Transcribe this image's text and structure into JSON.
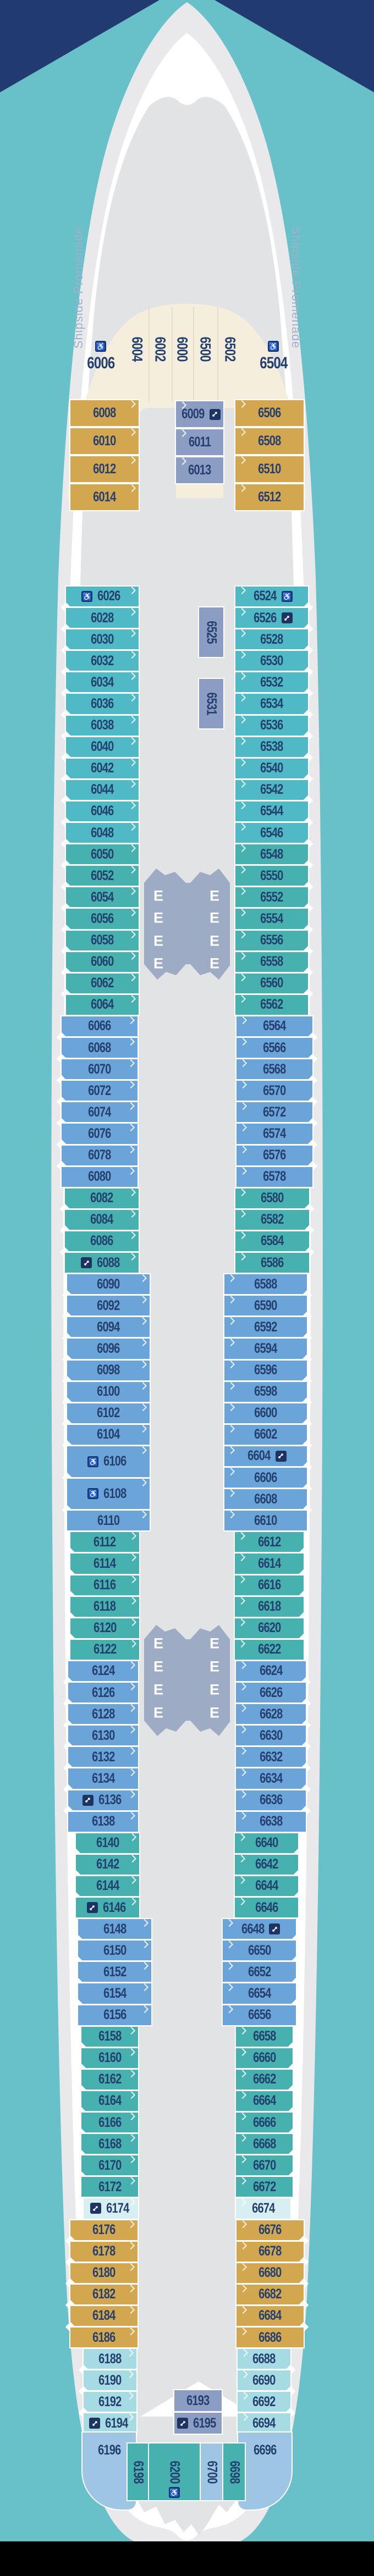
{
  "deck_plan": {
    "promenade_label": "Shipside Promenade",
    "elevator_letter": "E",
    "icons": {
      "wc": "wheelchair-accessible",
      "cx": "connecting-rooms"
    },
    "colors": {
      "background_teal": "#68c0c9",
      "background_navy": "#213a70",
      "background_black": "#000000",
      "hull_gray": "#e9e9eb",
      "promenade_white": "#ffffff",
      "deck_gray": "#e2e3e5",
      "lobby_gray_blue": "#9dabc4",
      "icon_navy": "#1d3462",
      "label_navy": "#25406e",
      "cabin_cream": "#f5eedd",
      "cabin_gold": "#d2a750",
      "cabin_periwinkle": "#8c9dc3",
      "cabin_steel_blue": "#6ba4d8",
      "cabin_light_blue": "#9ec5e4",
      "cabin_teal_cyan": "#4fbac5",
      "cabin_teal_green": "#46b1ae",
      "cabin_pale_cyan": "#a6dbe4",
      "cabin_palest_cyan": "#d7eff3"
    },
    "bow": {
      "fan_vertical_cabins": [
        {
          "n": "6004"
        },
        {
          "n": "6002"
        },
        {
          "n": "6000"
        },
        {
          "n": "6500"
        },
        {
          "n": "6502"
        }
      ],
      "fan_corner_cabins": [
        {
          "n": "6006",
          "ic": "wc"
        },
        {
          "n": "6504",
          "ic": "wc"
        }
      ],
      "gold_port": [
        {
          "n": "6008"
        },
        {
          "n": "6010"
        },
        {
          "n": "6012"
        },
        {
          "n": "6014"
        }
      ],
      "gold_starboard": [
        {
          "n": "6506"
        },
        {
          "n": "6508"
        },
        {
          "n": "6510"
        },
        {
          "n": "6512"
        }
      ],
      "interior_center": [
        {
          "n": "6009",
          "ic": "cx"
        },
        {
          "n": "6011"
        },
        {
          "n": "6013"
        }
      ]
    },
    "port_cabins": [
      {
        "n": "6026",
        "cat": "cyan",
        "ic": "wc"
      },
      {
        "n": "6028",
        "cat": "cyan"
      },
      {
        "n": "6030",
        "cat": "cyan"
      },
      {
        "n": "6032",
        "cat": "cyan"
      },
      {
        "n": "6034",
        "cat": "cyan"
      },
      {
        "n": "6036",
        "cat": "cyan"
      },
      {
        "n": "6038",
        "cat": "cyan"
      },
      {
        "n": "6040",
        "cat": "cyan"
      },
      {
        "n": "6042",
        "cat": "cyan"
      },
      {
        "n": "6044",
        "cat": "cyan"
      },
      {
        "n": "6046",
        "cat": "cyan"
      },
      {
        "n": "6048",
        "cat": "cyan"
      },
      {
        "n": "6050",
        "cat": "green"
      },
      {
        "n": "6052",
        "cat": "green"
      },
      {
        "n": "6054",
        "cat": "green"
      },
      {
        "n": "6056",
        "cat": "green"
      },
      {
        "n": "6058",
        "cat": "green"
      },
      {
        "n": "6060",
        "cat": "green"
      },
      {
        "n": "6062",
        "cat": "green"
      },
      {
        "n": "6064",
        "cat": "green"
      },
      {
        "n": "6066",
        "cat": "blue"
      },
      {
        "n": "6068",
        "cat": "blue"
      },
      {
        "n": "6070",
        "cat": "blue"
      },
      {
        "n": "6072",
        "cat": "blue"
      },
      {
        "n": "6074",
        "cat": "blue"
      },
      {
        "n": "6076",
        "cat": "blue"
      },
      {
        "n": "6078",
        "cat": "blue"
      },
      {
        "n": "6080",
        "cat": "blue"
      },
      {
        "n": "6082",
        "cat": "green"
      },
      {
        "n": "6084",
        "cat": "green"
      },
      {
        "n": "6086",
        "cat": "green"
      },
      {
        "n": "6088",
        "cat": "green",
        "ic": "cx"
      },
      {
        "n": "6090",
        "cat": "blue"
      },
      {
        "n": "6092",
        "cat": "blue"
      },
      {
        "n": "6094",
        "cat": "blue"
      },
      {
        "n": "6096",
        "cat": "blue"
      },
      {
        "n": "6098",
        "cat": "blue"
      },
      {
        "n": "6100",
        "cat": "blue"
      },
      {
        "n": "6102",
        "cat": "blue"
      },
      {
        "n": "6104",
        "cat": "blue"
      },
      {
        "n": "6106",
        "cat": "blue",
        "ic": "wc",
        "tall": true
      },
      {
        "n": "6108",
        "cat": "blue",
        "ic": "wc",
        "tall": true
      },
      {
        "n": "6110",
        "cat": "blue"
      },
      {
        "n": "6112",
        "cat": "green"
      },
      {
        "n": "6114",
        "cat": "green"
      },
      {
        "n": "6116",
        "cat": "green"
      },
      {
        "n": "6118",
        "cat": "green"
      },
      {
        "n": "6120",
        "cat": "green"
      },
      {
        "n": "6122",
        "cat": "green"
      },
      {
        "n": "6124",
        "cat": "blue"
      },
      {
        "n": "6126",
        "cat": "blue"
      },
      {
        "n": "6128",
        "cat": "blue"
      },
      {
        "n": "6130",
        "cat": "blue"
      },
      {
        "n": "6132",
        "cat": "blue"
      },
      {
        "n": "6134",
        "cat": "blue"
      },
      {
        "n": "6136",
        "cat": "blue",
        "ic": "cx"
      },
      {
        "n": "6138",
        "cat": "blue"
      },
      {
        "n": "6140",
        "cat": "green"
      },
      {
        "n": "6142",
        "cat": "green"
      },
      {
        "n": "6144",
        "cat": "green"
      },
      {
        "n": "6146",
        "cat": "green",
        "ic": "cx"
      },
      {
        "n": "6148",
        "cat": "blue"
      },
      {
        "n": "6150",
        "cat": "blue"
      },
      {
        "n": "6152",
        "cat": "blue"
      },
      {
        "n": "6154",
        "cat": "blue"
      },
      {
        "n": "6156",
        "cat": "blue"
      },
      {
        "n": "6158",
        "cat": "green"
      },
      {
        "n": "6160",
        "cat": "green"
      },
      {
        "n": "6162",
        "cat": "green"
      },
      {
        "n": "6164",
        "cat": "green"
      },
      {
        "n": "6166",
        "cat": "green"
      },
      {
        "n": "6168",
        "cat": "green"
      },
      {
        "n": "6170",
        "cat": "green"
      },
      {
        "n": "6172",
        "cat": "green"
      },
      {
        "n": "6174",
        "cat": "xpale",
        "ic": "cx"
      },
      {
        "n": "6176",
        "cat": "gold"
      },
      {
        "n": "6178",
        "cat": "gold"
      },
      {
        "n": "6180",
        "cat": "gold"
      },
      {
        "n": "6182",
        "cat": "gold"
      },
      {
        "n": "6184",
        "cat": "gold"
      },
      {
        "n": "6186",
        "cat": "gold"
      },
      {
        "n": "6188",
        "cat": "pale"
      },
      {
        "n": "6190",
        "cat": "pale"
      },
      {
        "n": "6192",
        "cat": "pale"
      },
      {
        "n": "6194",
        "cat": "pale",
        "ic": "cx"
      }
    ],
    "starboard_cabins": [
      {
        "n": "6524",
        "cat": "cyan",
        "ic": "wc"
      },
      {
        "n": "6526",
        "cat": "cyan",
        "ic": "cx"
      },
      {
        "n": "6528",
        "cat": "cyan"
      },
      {
        "n": "6530",
        "cat": "cyan"
      },
      {
        "n": "6532",
        "cat": "cyan"
      },
      {
        "n": "6534",
        "cat": "cyan"
      },
      {
        "n": "6536",
        "cat": "cyan"
      },
      {
        "n": "6538",
        "cat": "cyan"
      },
      {
        "n": "6540",
        "cat": "cyan"
      },
      {
        "n": "6542",
        "cat": "cyan"
      },
      {
        "n": "6544",
        "cat": "cyan"
      },
      {
        "n": "6546",
        "cat": "cyan"
      },
      {
        "n": "6548",
        "cat": "green"
      },
      {
        "n": "6550",
        "cat": "green"
      },
      {
        "n": "6552",
        "cat": "green"
      },
      {
        "n": "6554",
        "cat": "green"
      },
      {
        "n": "6556",
        "cat": "green"
      },
      {
        "n": "6558",
        "cat": "green"
      },
      {
        "n": "6560",
        "cat": "green"
      },
      {
        "n": "6562",
        "cat": "green"
      },
      {
        "n": "6564",
        "cat": "blue"
      },
      {
        "n": "6566",
        "cat": "blue"
      },
      {
        "n": "6568",
        "cat": "blue"
      },
      {
        "n": "6570",
        "cat": "blue"
      },
      {
        "n": "6572",
        "cat": "blue"
      },
      {
        "n": "6574",
        "cat": "blue"
      },
      {
        "n": "6576",
        "cat": "blue"
      },
      {
        "n": "6578",
        "cat": "blue"
      },
      {
        "n": "6580",
        "cat": "green"
      },
      {
        "n": "6582",
        "cat": "green"
      },
      {
        "n": "6584",
        "cat": "green"
      },
      {
        "n": "6586",
        "cat": "green"
      },
      {
        "n": "6588",
        "cat": "blue"
      },
      {
        "n": "6590",
        "cat": "blue"
      },
      {
        "n": "6592",
        "cat": "blue"
      },
      {
        "n": "6594",
        "cat": "blue"
      },
      {
        "n": "6596",
        "cat": "blue"
      },
      {
        "n": "6598",
        "cat": "blue"
      },
      {
        "n": "6600",
        "cat": "blue"
      },
      {
        "n": "6602",
        "cat": "blue"
      },
      {
        "n": "6604",
        "cat": "blue",
        "ic": "cx"
      },
      {
        "n": "6606",
        "cat": "blue"
      },
      {
        "n": "6608",
        "cat": "blue"
      },
      {
        "n": "6610",
        "cat": "blue"
      },
      {
        "n": "6612",
        "cat": "green"
      },
      {
        "n": "6614",
        "cat": "green"
      },
      {
        "n": "6616",
        "cat": "green"
      },
      {
        "n": "6618",
        "cat": "green"
      },
      {
        "n": "6620",
        "cat": "green"
      },
      {
        "n": "6622",
        "cat": "green"
      },
      {
        "n": "6624",
        "cat": "blue"
      },
      {
        "n": "6626",
        "cat": "blue"
      },
      {
        "n": "6628",
        "cat": "blue"
      },
      {
        "n": "6630",
        "cat": "blue"
      },
      {
        "n": "6632",
        "cat": "blue"
      },
      {
        "n": "6634",
        "cat": "blue"
      },
      {
        "n": "6636",
        "cat": "blue"
      },
      {
        "n": "6638",
        "cat": "blue"
      },
      {
        "n": "6640",
        "cat": "green"
      },
      {
        "n": "6642",
        "cat": "green"
      },
      {
        "n": "6644",
        "cat": "green"
      },
      {
        "n": "6646",
        "cat": "green"
      },
      {
        "n": "6648",
        "cat": "blue",
        "ic": "cx"
      },
      {
        "n": "6650",
        "cat": "blue"
      },
      {
        "n": "6652",
        "cat": "blue"
      },
      {
        "n": "6654",
        "cat": "blue"
      },
      {
        "n": "6656",
        "cat": "blue"
      },
      {
        "n": "6658",
        "cat": "green"
      },
      {
        "n": "6660",
        "cat": "green"
      },
      {
        "n": "6662",
        "cat": "green"
      },
      {
        "n": "6664",
        "cat": "green"
      },
      {
        "n": "6666",
        "cat": "green"
      },
      {
        "n": "6668",
        "cat": "green"
      },
      {
        "n": "6670",
        "cat": "green"
      },
      {
        "n": "6672",
        "cat": "green"
      },
      {
        "n": "6674",
        "cat": "xpale"
      },
      {
        "n": "6676",
        "cat": "gold"
      },
      {
        "n": "6678",
        "cat": "gold"
      },
      {
        "n": "6680",
        "cat": "gold"
      },
      {
        "n": "6682",
        "cat": "gold"
      },
      {
        "n": "6684",
        "cat": "gold"
      },
      {
        "n": "6686",
        "cat": "gold"
      },
      {
        "n": "6688",
        "cat": "pale"
      },
      {
        "n": "6690",
        "cat": "pale"
      },
      {
        "n": "6692",
        "cat": "pale"
      },
      {
        "n": "6694",
        "cat": "pale"
      }
    ],
    "midship_interior_cabins": [
      {
        "n": "6525"
      },
      {
        "n": "6531"
      }
    ],
    "stern": {
      "interior_center": [
        {
          "n": "6193"
        },
        {
          "n": "6195",
          "ic": "cx"
        }
      ],
      "corner_port": {
        "n": "6196"
      },
      "corner_starboard": {
        "n": "6696"
      },
      "vertical_cabins": [
        {
          "n": "6198",
          "cat": "green"
        },
        {
          "n": "6200",
          "cat": "green",
          "ic": "wc"
        },
        {
          "n": "6700",
          "cat": "lblue"
        },
        {
          "n": "6698",
          "cat": "green"
        }
      ]
    }
  }
}
